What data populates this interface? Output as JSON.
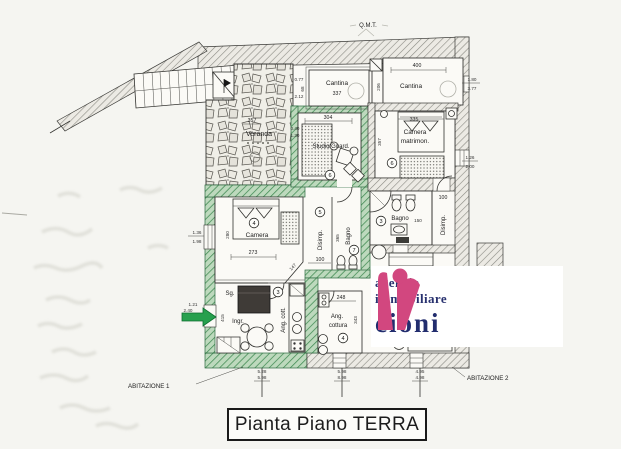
{
  "title": "Pianta Piano TERRA",
  "faint_note": "Q.M.T.",
  "logo": {
    "line1": "agenzia",
    "line2": "immobiliare",
    "line3": "cioni"
  },
  "apartments": {
    "a1": "ABITAZIONE 1",
    "a2": "ABITAZIONE 2"
  },
  "colors": {
    "wall_green": "#2fa24f",
    "logo_magenta": "#d2477f",
    "logo_navy": "#28316f"
  },
  "rooms": {
    "cantina1": {
      "name": "Cantina",
      "area": "337"
    },
    "cantina2": {
      "name": "Cantina",
      "width": "400"
    },
    "studio": {
      "name": "Studio/Guard.",
      "width": "304",
      "number": "6"
    },
    "veranda": {
      "name": "Veranda",
      "area": "357"
    },
    "camera_matr": {
      "name1": "Camera",
      "name2": "matrimon.",
      "width": "335",
      "depth": "357",
      "number": "6"
    },
    "camera": {
      "name": "Camera",
      "width": "181",
      "depth": "280",
      "bottom": "273",
      "diag": "147",
      "number": "4"
    },
    "disimp1": {
      "name": "Disimp.",
      "number": "5",
      "width": "100"
    },
    "bagno1": {
      "name": "Bagno",
      "number": "7",
      "depth": "365"
    },
    "bagno2": {
      "name": "Bagno",
      "number": "3",
      "dim": "150"
    },
    "disimp2": {
      "name": "Disimp.",
      "width": "100"
    },
    "soggiorno": {
      "name": "Sg.",
      "number": "3",
      "depth": "415"
    },
    "ingresso": {
      "name": "Ingr."
    },
    "ang_cott1": {
      "name": "Ang. cott."
    },
    "ang_cottura2": {
      "name1": "Ang.",
      "name2": "cottura",
      "width": "248",
      "depth": "343",
      "number": "4"
    }
  },
  "dims": {
    "cantina1_left": [
      "0.77",
      "2.12"
    ],
    "cantina1_left_v": "68",
    "cantina2_left_v": "206",
    "cantina2_right": [
      "1.80",
      "3.77"
    ],
    "studio_left": [
      "0.40",
      "1.30"
    ],
    "camera_matr_right": [
      "1.26",
      "2.00"
    ],
    "camera_left": [
      "1.36",
      "1.98"
    ],
    "entrance_left": [
      "1.21",
      "2.40"
    ],
    "bottom": [
      [
        "5.28",
        "5.98"
      ],
      [
        "5.98",
        "8.98"
      ],
      [
        "4.95",
        "4.98"
      ]
    ]
  }
}
